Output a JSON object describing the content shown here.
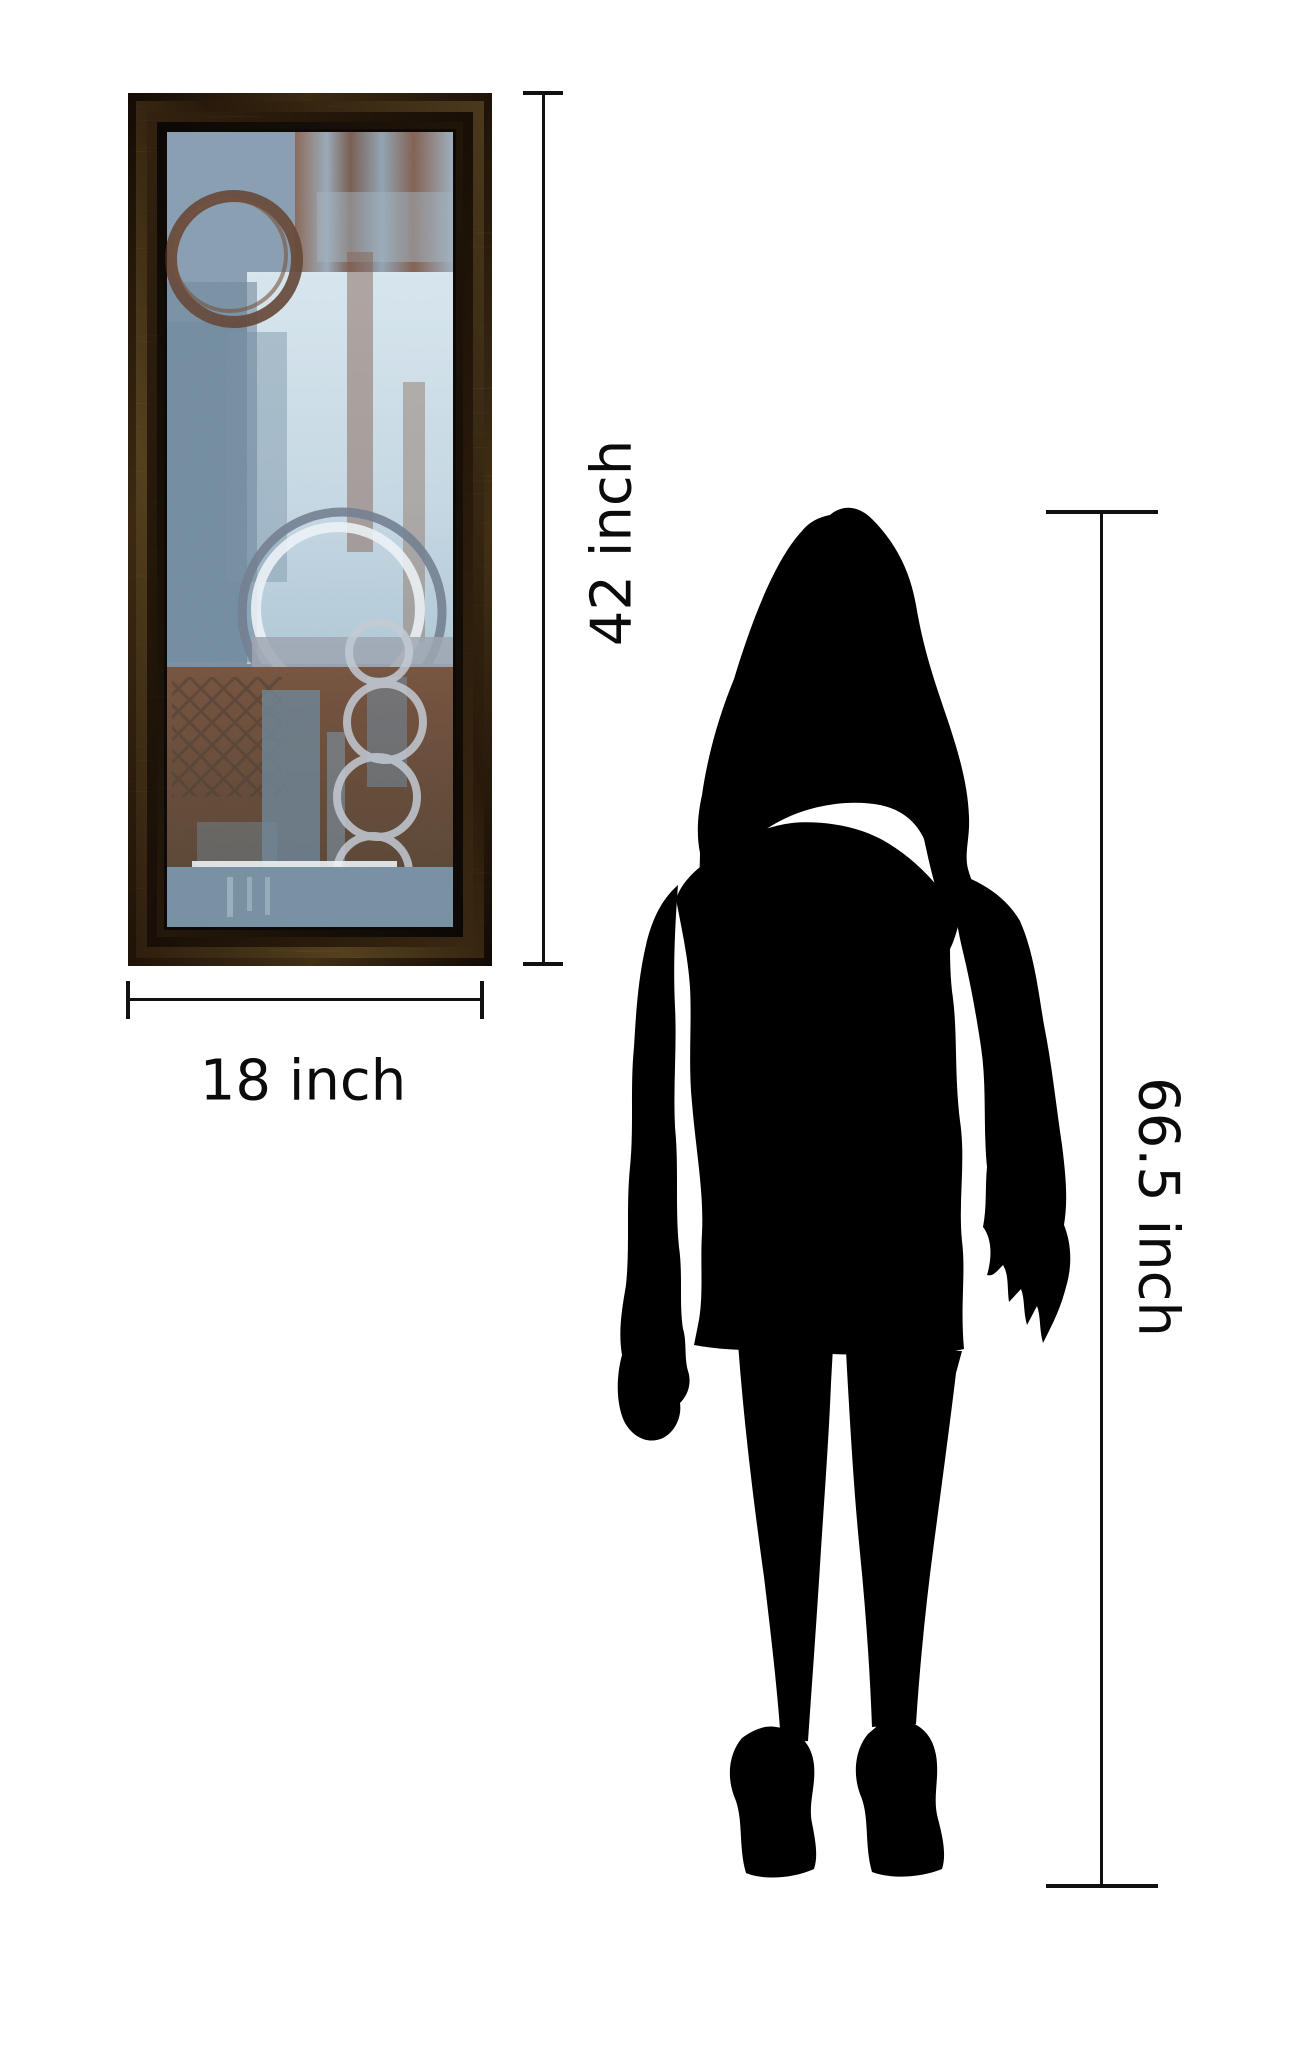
{
  "image_type": "product size comparison diagram",
  "canvas": {
    "width": 1296,
    "height": 2048,
    "background": "#ffffff"
  },
  "labels": {
    "art_height": "42 inch",
    "art_width": "18 inch",
    "person_height": "66.5 inch"
  },
  "artwork": {
    "description": "abstract blue and brown painting with circle motifs in ornate bronze frame",
    "height_inches": 42,
    "width_inches": 18,
    "colors": {
      "frame_bronze_dark": "#2a1a0c",
      "frame_bronze_light": "#9a7739",
      "art_slate_blue": "#5d7a91",
      "art_light_blue": "#c9dbe6",
      "art_rust_brown": "#5a3018",
      "ring_dark_brown": "#47220f",
      "ring_silver": "#b6bfca"
    }
  },
  "person": {
    "description": "standing woman silhouette, shoulder-length hair, high heels",
    "height_inches": 66.5,
    "color": "#000000"
  },
  "dimension_lines": {
    "color": "#111111"
  }
}
